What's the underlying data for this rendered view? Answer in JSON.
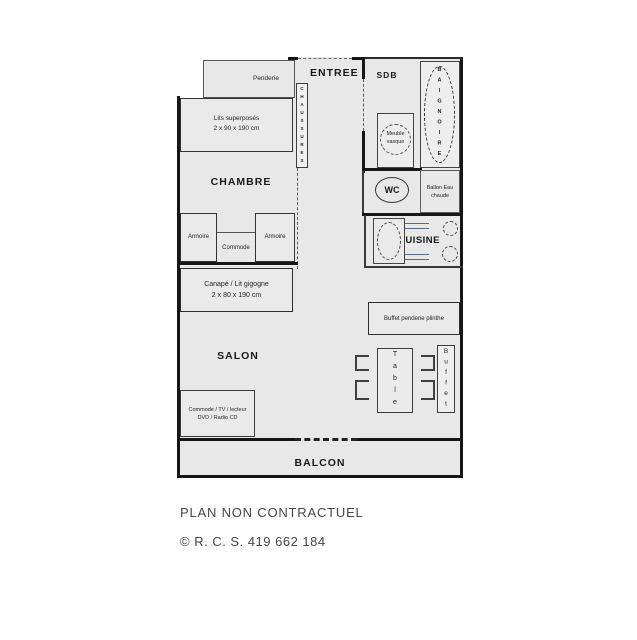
{
  "page": {
    "disclaimer": "PLAN NON CONTRACTUEL",
    "copyright": "© R. C. S. 419 662 184"
  },
  "colors": {
    "plan_background": "#e8e8e8",
    "wall": "#161616",
    "label_text": "#1f1f1f",
    "footer_text": "#45454b",
    "kitchen_accent": "#5b6b85"
  },
  "rooms": {
    "entree": "ENTREE",
    "sdb": "SDB",
    "chambre": "CHAMBRE",
    "cuisine": "CUISINE",
    "salon": "SALON",
    "balcon": "BALCON",
    "wc": "WC"
  },
  "furniture": {
    "penderie": "Penderie",
    "chaussures": "CHAUSSURES",
    "lits": {
      "line1": "Lits superposés",
      "line2": "2 x 90 x 190 cm"
    },
    "armoire_gauche": "Armoire",
    "commode": "Commode",
    "armoire_droite": "Armoire",
    "canape": {
      "line1": "Canapé / Lit gigogne",
      "line2": "2 x 80 x 190 cm"
    },
    "meuble_vasque": {
      "line1": "Meuble",
      "line2": "vasque"
    },
    "baignoire": "BAIGNOIRE",
    "ballon": {
      "line1": "Ballon Eau",
      "line2": "chaude"
    },
    "buffet_penderie": "Buffet penderie plinthe",
    "table": "Table",
    "buffet": "Buffet",
    "commode_tv": {
      "line1": "Commode / TV / lecteur",
      "line2": "DVD / Radio CD"
    }
  }
}
